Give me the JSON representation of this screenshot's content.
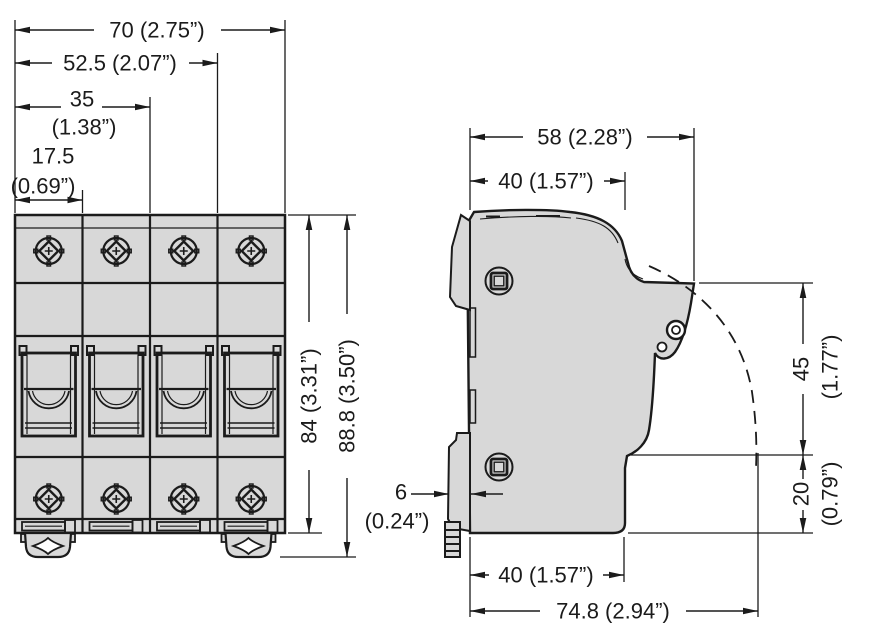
{
  "colors": {
    "line": "#1b1b1b",
    "body_fill": "#d8d8d8",
    "background": "#ffffff"
  },
  "dims": {
    "front": {
      "width_total": "70 (2.75”)",
      "width_3mod": "52.5 (2.07”)",
      "width_2mod": "35",
      "width_2mod_in": "(1.38”)",
      "width_1mod": "17.5",
      "width_1mod_in": "(0.69”)",
      "height_body": "84 (3.31”)",
      "height_total": "88.8 (3.50”)"
    },
    "side": {
      "depth_top_total": "58 (2.28”)",
      "depth_top_front": "40 (1.57”)",
      "rail_offset": "6",
      "rail_offset_in": "(0.24”)",
      "height_handle": "45",
      "height_handle_in": "(1.77”)",
      "height_lower": "20",
      "height_lower_in": "(0.79”)",
      "depth_bottom_front": "40 (1.57”)",
      "depth_bottom_total": "74.8 (2.94”)"
    }
  }
}
